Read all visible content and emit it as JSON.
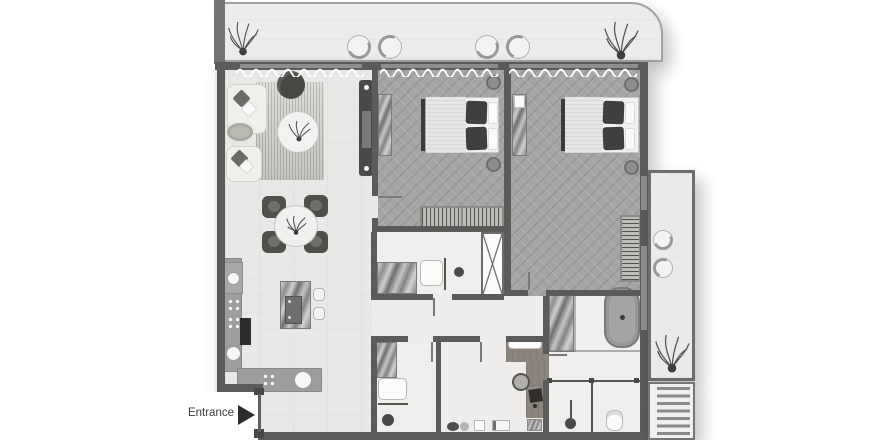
{
  "labels": {
    "entrance": "Entrance"
  },
  "icons": {
    "entrance_arrow": "right-pointing-triangle",
    "shaft_cross": "x-cross",
    "plants": "scribble-plant"
  },
  "palette": {
    "wall": "#5b5b5a",
    "floor_living": "#e9e8e6",
    "floor_bedroom": "#a6a5a3",
    "floor_bath": "#f0efed",
    "terrace_floor": "#ececea",
    "counter": "#9e9d9b",
    "wood": "#8b857d",
    "dark_furniture": "#4f4e4b",
    "arrow": "#2c2c2b"
  }
}
